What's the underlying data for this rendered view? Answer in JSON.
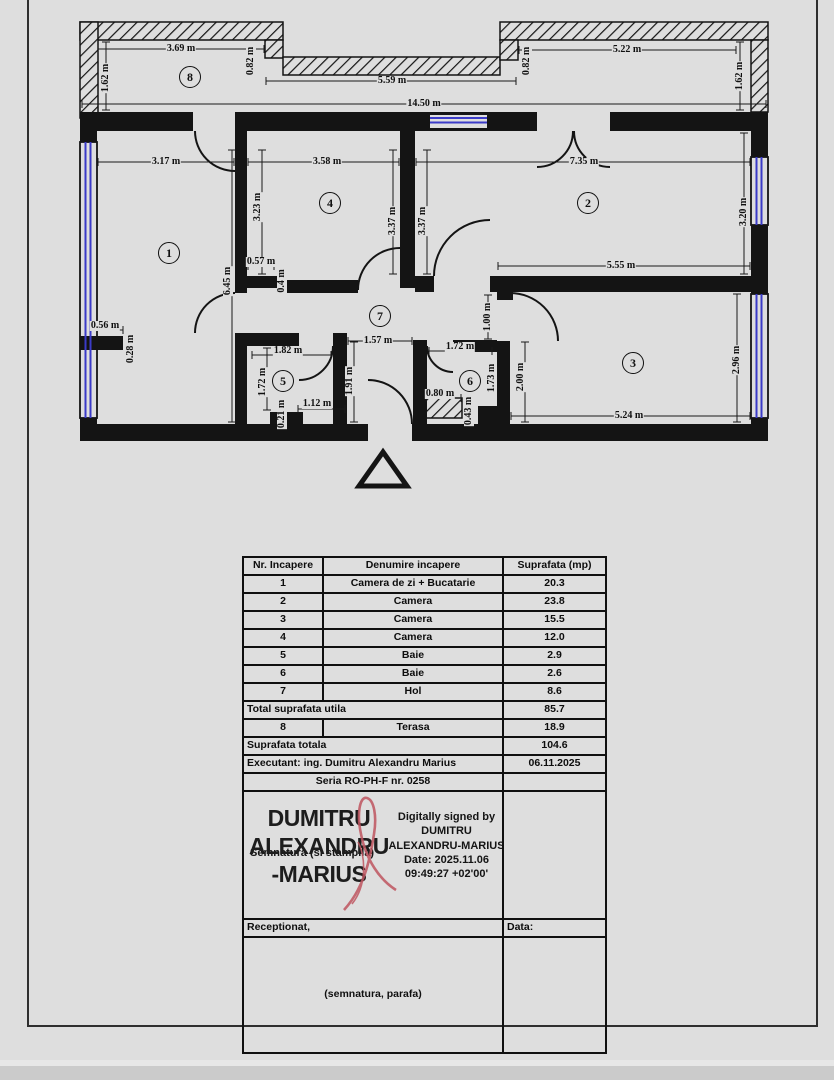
{
  "page": {
    "background": "#dedede",
    "frame_color": "#2e2e2e"
  },
  "floor_plan": {
    "wall_color": "#141414",
    "window_color": "#3b3bc8",
    "entrance_marker": "triangle",
    "rooms": [
      {
        "n": "1",
        "x": 169,
        "y": 253
      },
      {
        "n": "2",
        "x": 588,
        "y": 203
      },
      {
        "n": "3",
        "x": 633,
        "y": 363
      },
      {
        "n": "4",
        "x": 330,
        "y": 203
      },
      {
        "n": "5",
        "x": 283,
        "y": 381
      },
      {
        "n": "6",
        "x": 470,
        "y": 381
      },
      {
        "n": "7",
        "x": 380,
        "y": 316
      },
      {
        "n": "8",
        "x": 190,
        "y": 77
      }
    ],
    "dimensions": [
      {
        "t": "3.69 m",
        "x": 181,
        "y": 49,
        "line": [
          98,
          49,
          264,
          49
        ]
      },
      {
        "t": "1.62 m",
        "x": 106,
        "y": 78,
        "r": 1,
        "line": [
          106,
          42,
          106,
          110
        ]
      },
      {
        "t": "0.82 m",
        "x": 251,
        "y": 61,
        "r": 1
      },
      {
        "t": "5.59 m",
        "x": 392,
        "y": 81,
        "line": [
          266,
          81,
          516,
          81
        ]
      },
      {
        "t": "14.50 m",
        "x": 424,
        "y": 104,
        "line": [
          82,
          104,
          766,
          104
        ]
      },
      {
        "t": "5.22 m",
        "x": 627,
        "y": 50,
        "line": [
          519,
          50,
          736,
          50
        ]
      },
      {
        "t": "0.82 m",
        "x": 527,
        "y": 61,
        "r": 1
      },
      {
        "t": "1.62 m",
        "x": 740,
        "y": 76,
        "r": 1,
        "line": [
          740,
          42,
          740,
          110
        ]
      },
      {
        "t": "3.17 m",
        "x": 166,
        "y": 162,
        "line": [
          98,
          162,
          234,
          162
        ]
      },
      {
        "t": "6.45 m",
        "x": 228,
        "y": 281,
        "r": 1,
        "line": [
          232,
          150,
          232,
          422
        ]
      },
      {
        "t": "0.56 m",
        "x": 105,
        "y": 326,
        "line": [
          97,
          330,
          123,
          330
        ]
      },
      {
        "t": "0.28 m",
        "x": 131,
        "y": 349,
        "r": 1
      },
      {
        "t": "3.58 m",
        "x": 327,
        "y": 162,
        "line": [
          248,
          162,
          399,
          162
        ]
      },
      {
        "t": "3.23 m",
        "x": 258,
        "y": 207,
        "r": 1,
        "line": [
          262,
          150,
          262,
          274
        ]
      },
      {
        "t": "0.57 m",
        "x": 261,
        "y": 262,
        "line": [
          248,
          266,
          274,
          266
        ]
      },
      {
        "t": "0.4 m",
        "x": 282,
        "y": 281,
        "r": 1
      },
      {
        "t": "7.35 m",
        "x": 584,
        "y": 162,
        "line": [
          416,
          162,
          750,
          162
        ]
      },
      {
        "t": "3.37 m",
        "x": 393,
        "y": 221,
        "r": 1,
        "line": [
          393,
          150,
          393,
          274
        ]
      },
      {
        "t": "3.37 m",
        "x": 423,
        "y": 221,
        "r": 1,
        "line": [
          427,
          150,
          427,
          274
        ]
      },
      {
        "t": "3.20 m",
        "x": 744,
        "y": 212,
        "r": 1,
        "line": [
          744,
          133,
          744,
          274
        ]
      },
      {
        "t": "5.55 m",
        "x": 621,
        "y": 266,
        "line": [
          498,
          266,
          750,
          266
        ]
      },
      {
        "t": "2.96 m",
        "x": 737,
        "y": 360,
        "r": 1,
        "line": [
          737,
          294,
          737,
          422
        ]
      },
      {
        "t": "2.00 m",
        "x": 521,
        "y": 377,
        "r": 1,
        "line": [
          525,
          342,
          525,
          422
        ]
      },
      {
        "t": "5.24 m",
        "x": 629,
        "y": 416,
        "line": [
          511,
          416,
          750,
          416
        ]
      },
      {
        "t": "1.00 m",
        "x": 488,
        "y": 317,
        "r": 1,
        "line": [
          488,
          295,
          488,
          339
        ]
      },
      {
        "t": "1.57 m",
        "x": 378,
        "y": 341,
        "line": [
          348,
          341,
          412,
          341
        ]
      },
      {
        "t": "1.91 m",
        "x": 350,
        "y": 381,
        "r": 1,
        "line": [
          354,
          342,
          354,
          422
        ]
      },
      {
        "t": "1.82 m",
        "x": 288,
        "y": 351,
        "line": [
          252,
          355,
          331,
          355
        ]
      },
      {
        "t": "1.72 m",
        "x": 263,
        "y": 382,
        "r": 1,
        "line": [
          267,
          348,
          267,
          410
        ]
      },
      {
        "t": "1.12 m",
        "x": 317,
        "y": 404,
        "line": [
          298,
          409,
          345,
          409
        ]
      },
      {
        "t": "0.21 m",
        "x": 282,
        "y": 414,
        "r": 1
      },
      {
        "t": "1.72 m",
        "x": 460,
        "y": 347,
        "line": [
          429,
          351,
          492,
          351
        ]
      },
      {
        "t": "1.73 m",
        "x": 492,
        "y": 378,
        "r": 1
      },
      {
        "t": "0.80 m",
        "x": 440,
        "y": 394,
        "line": [
          426,
          398,
          461,
          398
        ]
      },
      {
        "t": "0.43 m",
        "x": 469,
        "y": 411,
        "r": 1
      }
    ]
  },
  "table": {
    "rows": [
      {
        "cells": [
          {
            "t": "Nr. Incapere"
          },
          {
            "t": "Denumire incapere"
          },
          {
            "t": "Suprafata (mp)"
          }
        ]
      },
      {
        "cells": [
          {
            "t": "1"
          },
          {
            "t": "Camera de zi + Bucatarie"
          },
          {
            "t": "20.3"
          }
        ]
      },
      {
        "cells": [
          {
            "t": "2"
          },
          {
            "t": "Camera"
          },
          {
            "t": "23.8"
          }
        ]
      },
      {
        "cells": [
          {
            "t": "3"
          },
          {
            "t": "Camera"
          },
          {
            "t": "15.5"
          }
        ]
      },
      {
        "cells": [
          {
            "t": "4"
          },
          {
            "t": "Camera"
          },
          {
            "t": "12.0"
          }
        ]
      },
      {
        "cells": [
          {
            "t": "5"
          },
          {
            "t": "Baie"
          },
          {
            "t": "2.9"
          }
        ]
      },
      {
        "cells": [
          {
            "t": "6"
          },
          {
            "t": "Baie"
          },
          {
            "t": "2.6"
          }
        ]
      },
      {
        "cells": [
          {
            "t": "7"
          },
          {
            "t": "Hol"
          },
          {
            "t": "8.6"
          }
        ]
      },
      {
        "cells": [
          {
            "t": "Total suprafata utila",
            "span": 2,
            "left": true
          },
          {
            "t": "85.7"
          }
        ]
      },
      {
        "cells": [
          {
            "t": "8"
          },
          {
            "t": "Terasa"
          },
          {
            "t": "18.9"
          }
        ]
      },
      {
        "cells": [
          {
            "t": "Suprafata totala",
            "span": 2,
            "left": true
          },
          {
            "t": "104.6"
          }
        ]
      },
      {
        "cells": [
          {
            "t": "Executant: ing. Dumitru Alexandru Marius",
            "span": 2,
            "left": true
          },
          {
            "t": "06.11.2025"
          }
        ]
      },
      {
        "cells": [
          {
            "t": "Seria RO-PH-F nr. 0258",
            "span": 2
          },
          {
            "t": ""
          }
        ]
      }
    ]
  },
  "signature": {
    "behind_label": "Semnatura (si stampila)",
    "name_lines": [
      "DUMITRU",
      "ALEXANDRU",
      "-MARIUS"
    ],
    "details": [
      "Digitally signed by",
      "DUMITRU",
      "ALEXANDRU-MARIUS",
      "Date: 2025.11.06",
      "09:49:27 +02'00'"
    ],
    "ribbon_color": "#bf5560"
  },
  "reception": {
    "left_label": "Receptionat,",
    "right_label": "Data:",
    "note": "(semnatura, parafa)"
  }
}
